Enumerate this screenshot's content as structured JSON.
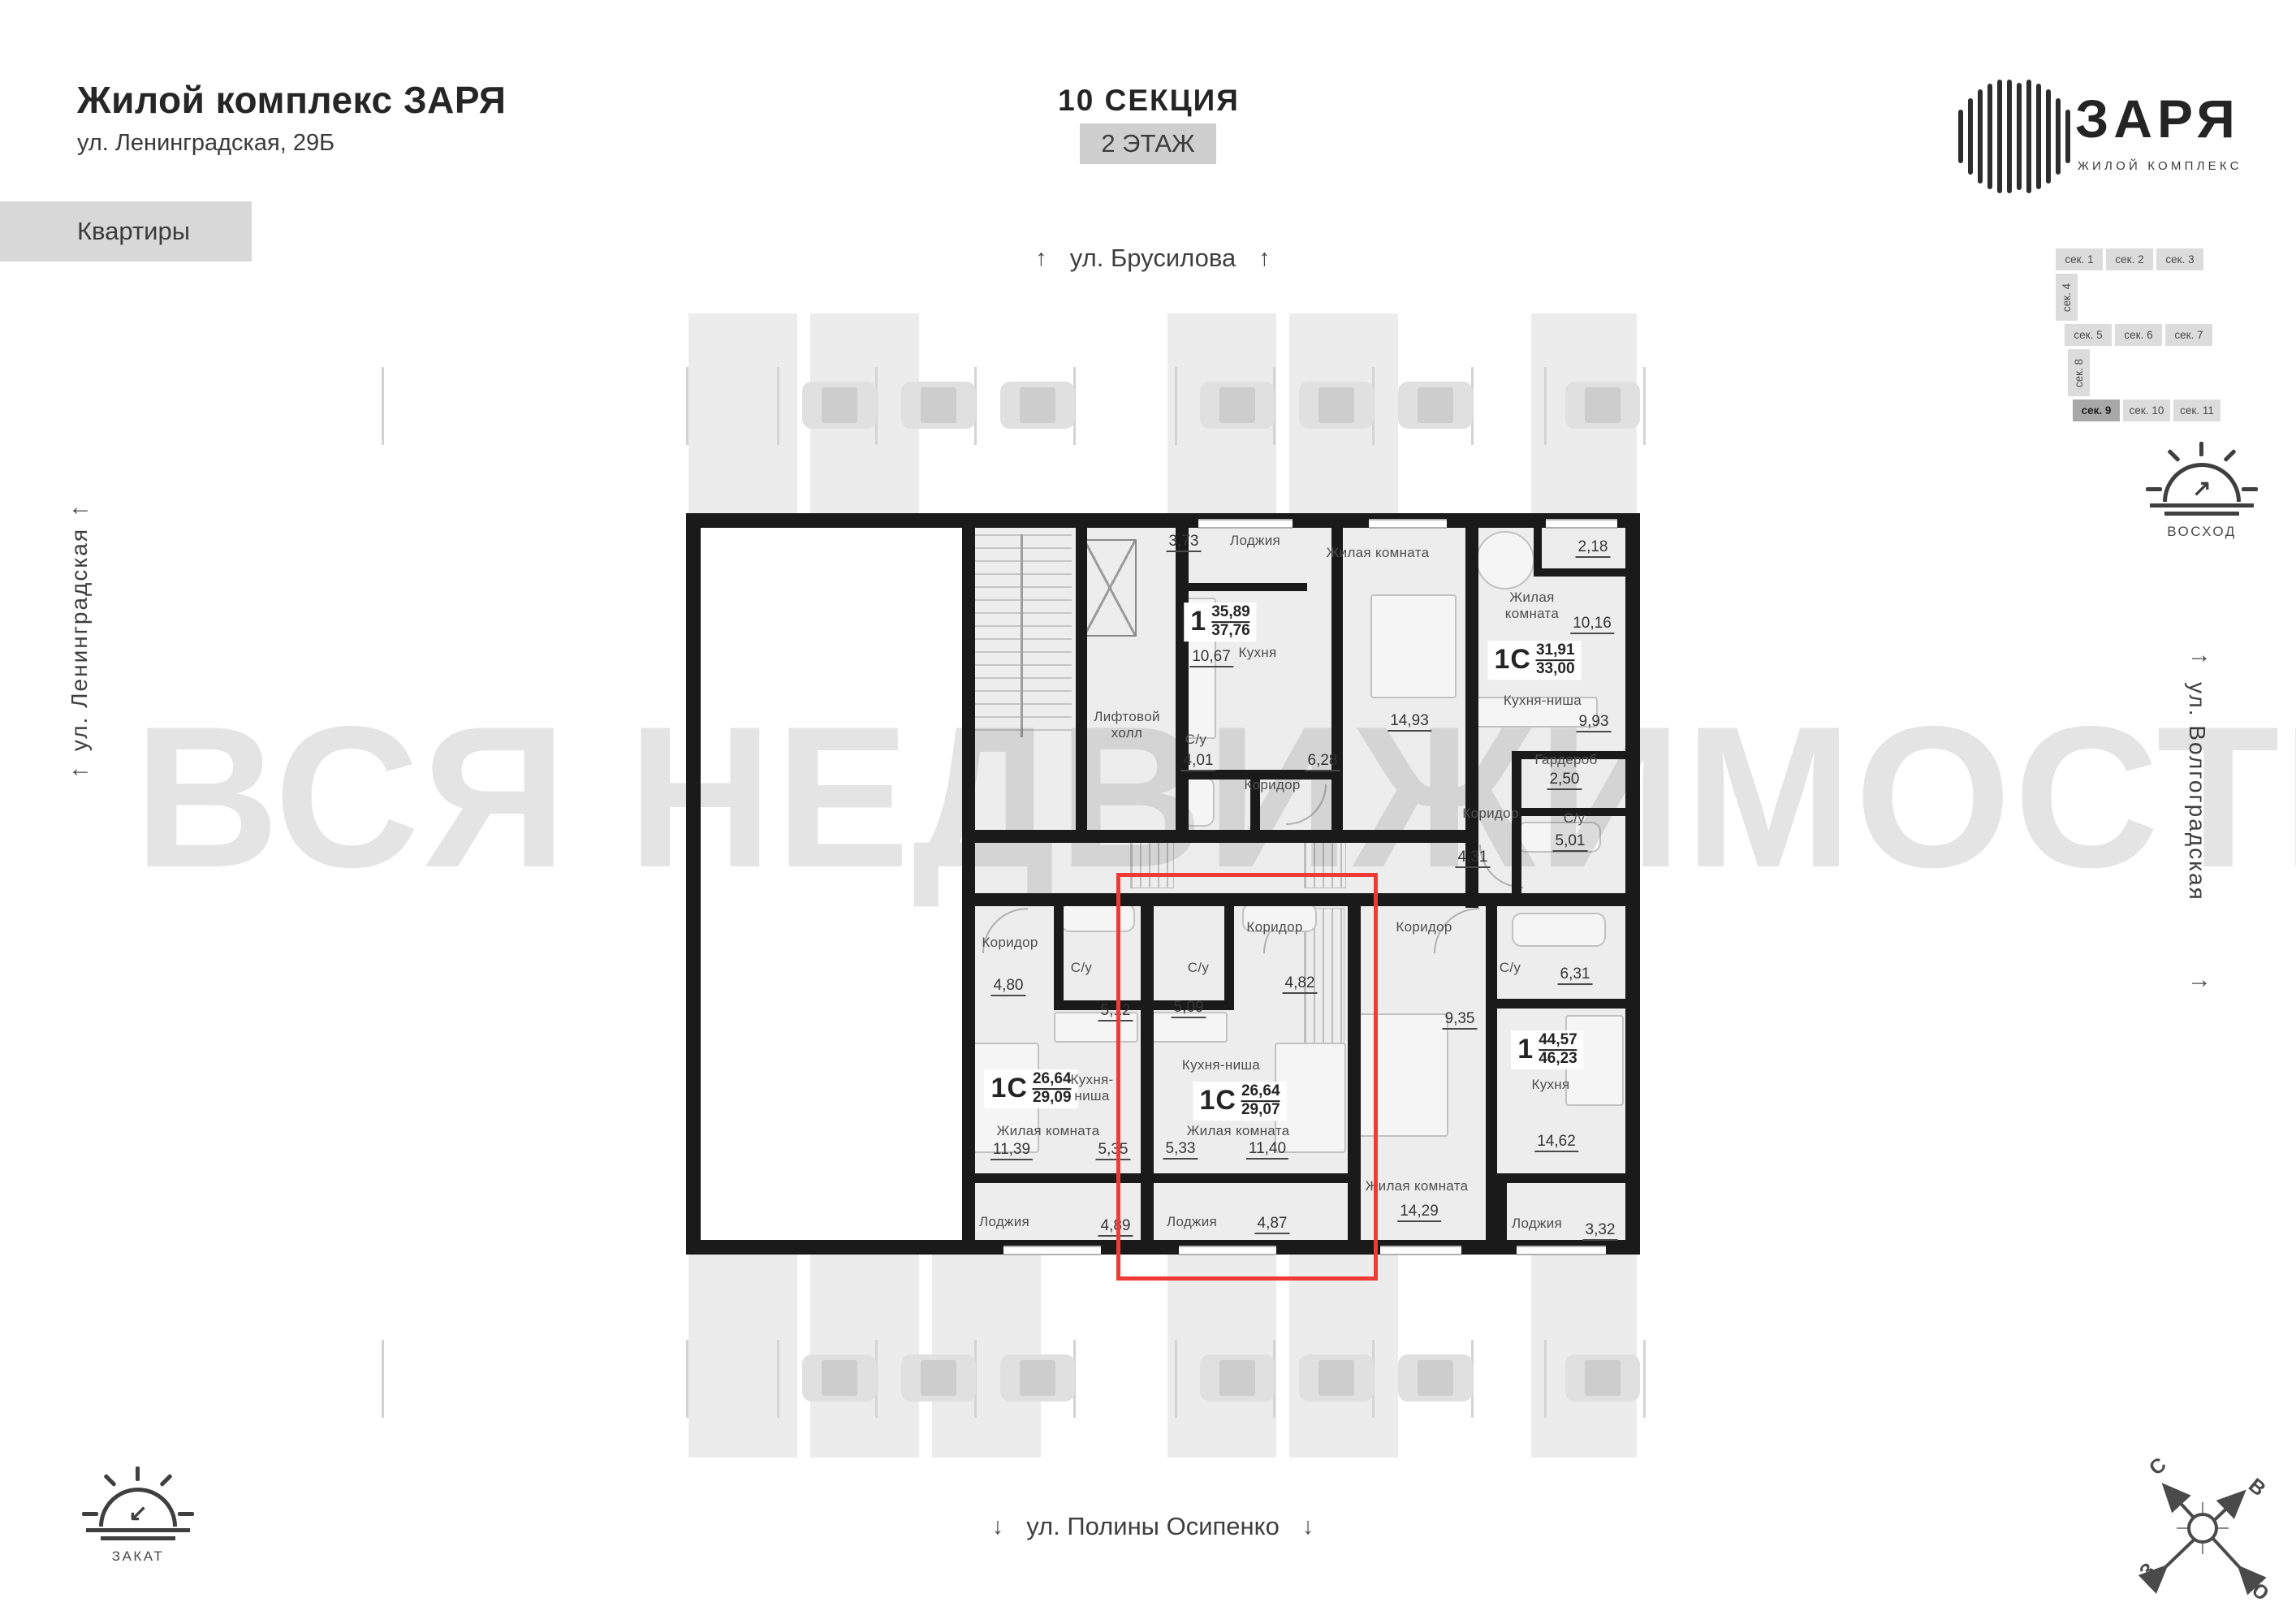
{
  "header": {
    "title": "Жилой комплекс ЗАРЯ",
    "address": "ул. Ленинградская, 29Б",
    "tab": "Квартиры",
    "section": "10 СЕКЦИЯ",
    "floor": "2 ЭТАЖ"
  },
  "logo": {
    "name": "ЗАРЯ",
    "tagline": "ЖИЛОЙ КОМПЛЕКС"
  },
  "streets": {
    "top": "ул. Брусилова",
    "left": "ул. Ленинградская",
    "right": "ул. Волгоградская",
    "bottom": "ул. Полины Осипенко"
  },
  "sun_markers": {
    "sunrise": "ВОСХОД",
    "sunset": "ЗАКАТ"
  },
  "compass": {
    "north": "С",
    "east": "В",
    "west": "З",
    "south": "Ю"
  },
  "icons": {
    "arrow_up": "↑",
    "arrow_down": "↓",
    "arrow_left": "←",
    "arrow_right": "→",
    "arrow_sunrise": "↗",
    "arrow_sunset": "↙"
  },
  "section_map": {
    "row1": [
      "сек. 1",
      "сек. 2",
      "сек. 3"
    ],
    "vertical1": "сек. 4",
    "row2": [
      "сек. 5",
      "сек. 6",
      "сек. 7"
    ],
    "vertical2": "сек. 8",
    "row3": [
      "сек. 9",
      "сек. 10",
      "сек. 11"
    ],
    "highlighted": "сек. 9"
  },
  "watermark": "ВСЯ НЕДВИЖИМОСТЬ",
  "plan": {
    "lift_hall": "Лифтовой холл",
    "apartments": [
      {
        "id": "apt-top-left",
        "type": "1",
        "area1": "35,89",
        "area2": "37,76",
        "rooms": [
          {
            "n": "Лоджия",
            "a": "3,73"
          },
          {
            "n": "Кухня",
            "a": "10,67"
          },
          {
            "n": "С/у",
            "a": "4,01"
          },
          {
            "n": "Коридор",
            "a": "6,28"
          },
          {
            "n": "Жилая комната",
            "a": "14,93"
          }
        ]
      },
      {
        "id": "apt-top-right",
        "type": "1С",
        "area1": "31,91",
        "area2": "33,00",
        "rooms": [
          {
            "n": "",
            "a": "2,18"
          },
          {
            "n": "Жилая комната",
            "a": "10,16"
          },
          {
            "n": "Кухня-ниша",
            "a": "9,93"
          },
          {
            "n": "Гардероб",
            "a": "2,50"
          },
          {
            "n": "Коридор",
            "a": "4,31"
          },
          {
            "n": "С/у",
            "a": "5,01"
          }
        ]
      },
      {
        "id": "apt-bottom-left",
        "type": "1С",
        "area1": "26,64",
        "area2": "29,09",
        "rooms": [
          {
            "n": "Коридор",
            "a": "4,80"
          },
          {
            "n": "С/у",
            "a": "5,12"
          },
          {
            "n": "Кухня-ниша",
            "a": "5,35"
          },
          {
            "n": "Жилая комната",
            "a": "11,39"
          },
          {
            "n": "Лоджия",
            "a": "4,89"
          }
        ]
      },
      {
        "id": "apt-selected",
        "type": "1С",
        "area1": "26,64",
        "area2": "29,07",
        "selected": true,
        "rooms": [
          {
            "n": "Коридор",
            "a": "4,82"
          },
          {
            "n": "С/у",
            "a": "5,09"
          },
          {
            "n": "Кухня-ниша",
            "a": "5,33"
          },
          {
            "n": "Жилая комната",
            "a": "11,40"
          },
          {
            "n": "Лоджия",
            "a": "4,87"
          }
        ]
      },
      {
        "id": "apt-bottom-right",
        "type": "1",
        "area1": "44,57",
        "area2": "46,23",
        "rooms": [
          {
            "n": "Коридор",
            "a": "9,35"
          },
          {
            "n": "С/у",
            "a": "6,31"
          },
          {
            "n": "Кухня",
            "a": "14,62"
          },
          {
            "n": "Жилая комната",
            "a": "14,29"
          },
          {
            "n": "Лоджия",
            "a": "3,32"
          }
        ]
      }
    ]
  }
}
